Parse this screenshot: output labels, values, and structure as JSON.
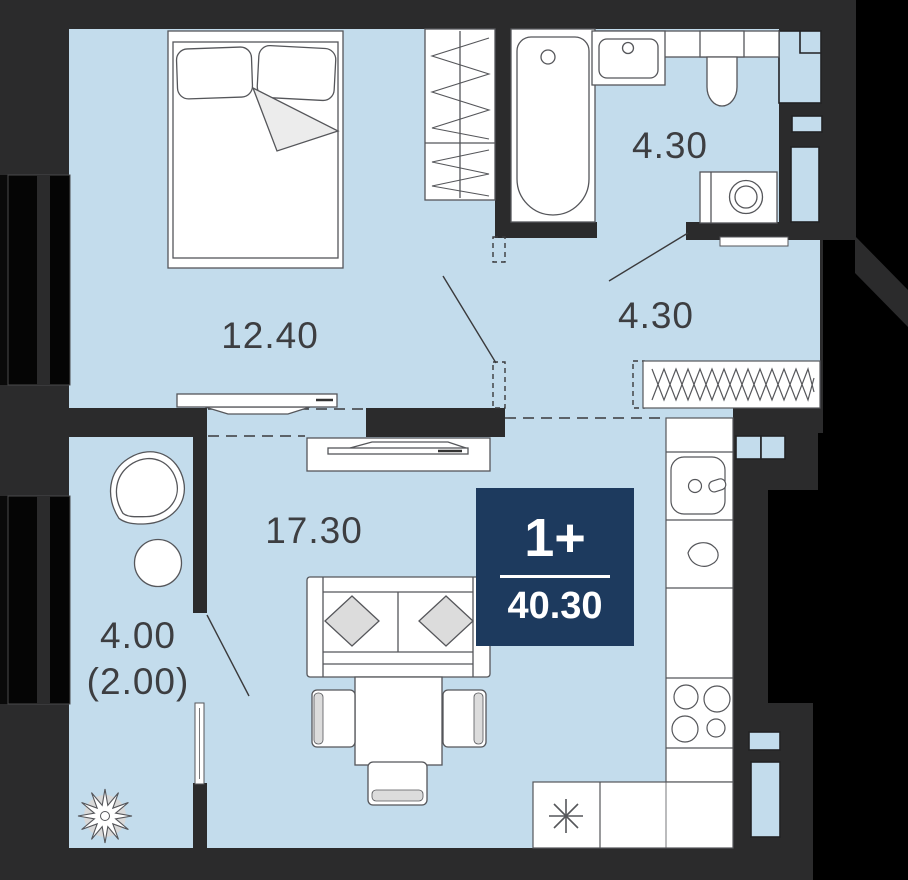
{
  "plan": {
    "title_badge": {
      "rooms": "1+",
      "area": "40.30"
    },
    "rooms": [
      {
        "name": "bedroom",
        "area": "12.40"
      },
      {
        "name": "bathroom",
        "area": "4.30"
      },
      {
        "name": "hallway",
        "area": "4.30"
      },
      {
        "name": "living-room-kitchen",
        "area": "17.30"
      },
      {
        "name": "balcony",
        "area_total": "4.00",
        "area_reduced": "(2.00)"
      }
    ],
    "colors": {
      "floor": "#c3dcec",
      "wall": "#2b2b2c",
      "outside": "#000000",
      "badge": "#1d3a5e",
      "badge_text": "#ffffff",
      "furniture_line": "#55565a",
      "label_text": "#3d3e41"
    },
    "fixtures": [
      "double-bed",
      "bedroom-wardrobe",
      "bathtub",
      "washbasin",
      "toilet",
      "washing-machine",
      "entrance-door",
      "hall-closet",
      "tv-stand-bedroom",
      "tv-stand-living",
      "sofa",
      "dining-table",
      "chair",
      "kitchen-counter",
      "kitchen-sink",
      "stove",
      "refrigerator",
      "balcony-armchair",
      "balcony-table",
      "plant",
      "ventilation-shaft",
      "window",
      "balcony-door"
    ]
  }
}
